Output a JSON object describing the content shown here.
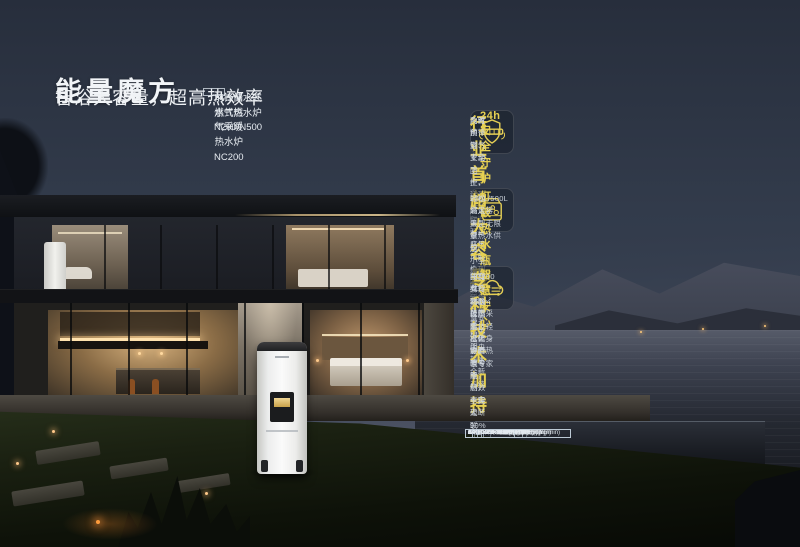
{
  "accent": {
    "gold": "#e6d052",
    "text_light": "#f2f5f8",
    "body_text": "#cad1d9"
  },
  "header": {
    "title": "能量魔方",
    "subtitle": "智浴大容量，超高热效率",
    "models_line1": "前锋储水式燃气热水炉N200/N500",
    "models_line2": "前锋储水式燃气采暖热水炉NC200"
  },
  "features": [
    {
      "icon": "shield-badge-icon",
      "title": "行业首创",
      "tagline": "24h安全守护",
      "lines": [
        "内置前锋燃气安全卫士，全天候实时监测家庭用气安全",
        "及时预警、主动防控、远程操作，开启从被动防护到主动监测的智慧安全革命"
      ]
    },
    {
      "icon": "water-tank-icon",
      "title": "超大容量",
      "tagline": "打破热水瓶颈",
      "lines": [
        "200L/500L超大容量，无限量热水供应",
        "轻松满足大型家用、小型商用等多元场景需求，构建中央热水全新系统"
      ]
    },
    {
      "icon": "cloud-connect-icon",
      "title": "专利技术加持",
      "tagline": "智慧安心",
      "lines": [
        "三变频专利分段燃烧技术，静音节能，热效率突破90%",
        "独有4G物联技术，打破WiFi信号限制，全程无断联",
        "NC200支持250㎡范围采暖，轻松化身全屋热暖专家"
      ]
    }
  ],
  "spec_table": {
    "header_row": {
      "label": "产品型号",
      "values": [
        "GRSG28-N200(T)",
        "GRSG28-N500(T)",
        "CRLG28-NC200(T)"
      ]
    },
    "rows": [
      {
        "label": "额定容积(L)",
        "span": false,
        "values": [
          "200",
          "500",
          "200"
        ]
      },
      {
        "label": "能效等级",
        "span": true,
        "values": [
          "二级"
        ]
      },
      {
        "label": "热效率",
        "span": true,
        "values": [
          "89%"
        ]
      },
      {
        "label": "外形尺寸[宽×深×高](mm)",
        "span": false,
        "values": [
          "520×776×1645",
          "700×848×1915",
          "520×782×1645"
        ]
      },
      {
        "label": "供暖参考面积(㎡)",
        "span": false,
        "values": [
          "/",
          "/",
          "60-210"
        ]
      },
      {
        "label": "采暖最小热输出(kW)",
        "span": false,
        "values": [
          "/",
          "/",
          "6"
        ]
      },
      {
        "label": "△t=25K时的产热水能力(kg/min)",
        "span": false,
        "values": [
          "14",
          "14",
          "14"
        ]
      }
    ]
  }
}
